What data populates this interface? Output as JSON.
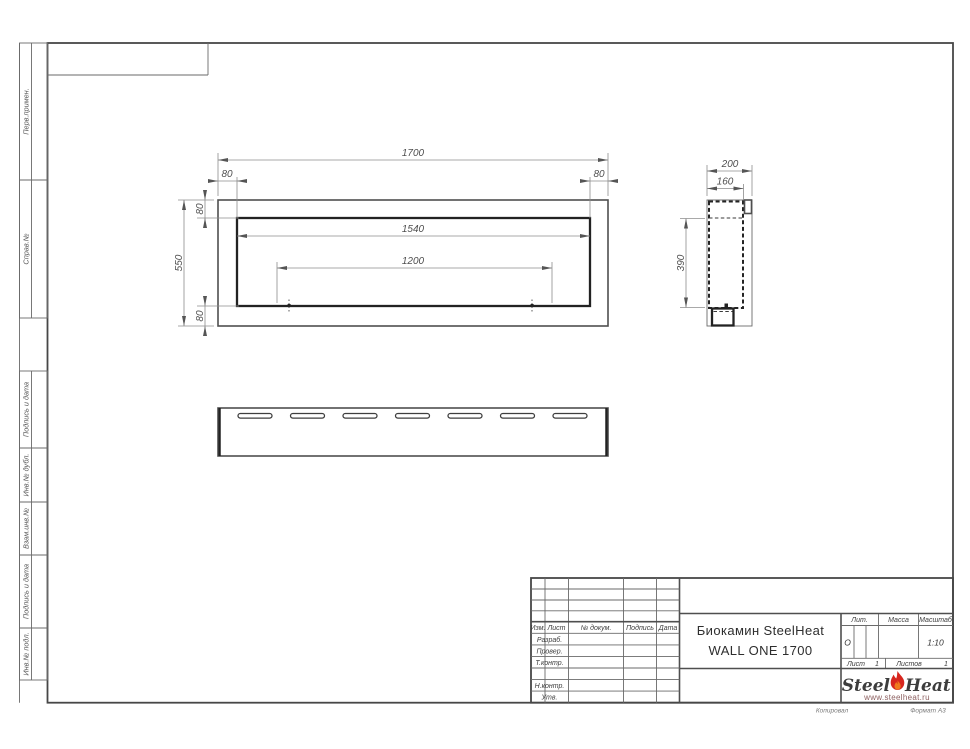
{
  "sheet": {
    "margin_labels_top": [
      "Перв.примен.",
      "Справ.№"
    ],
    "margin_labels_bottom": [
      "Подпись и дата",
      "Инв.№ дубл.",
      "Взам.инв.№",
      "Подпись и дата",
      "Инв.№ подл."
    ],
    "footer": {
      "copy_note": "Копировал",
      "format_note": "Формат А3"
    }
  },
  "drawing": {
    "front_view": {
      "width_total": "1700",
      "offset_left": "80",
      "offset_right": "80",
      "offset_top": "80",
      "height_total": "550",
      "width_inner": "1540",
      "mount_spacing": "1200",
      "offset_bottom": "80"
    },
    "side_view": {
      "depth_total": "200",
      "depth_inner": "160",
      "height_inner": "390"
    }
  },
  "title_block": {
    "columns": {
      "izm": "Изм.",
      "list": "Лист",
      "doc_no": "№ докум.",
      "podpis": "Подпись",
      "data": "Дата"
    },
    "rows": {
      "razrab": "Разраб.",
      "prover": "Провер.",
      "t_kontr": "Т.контр.",
      "n_kontr": "Н.контр.",
      "utv": "Утв."
    },
    "doc_title_line1": "Биокамин SteelHeat",
    "doc_title_line2": "WALL ONE 1700",
    "lit": {
      "label": "Лит.",
      "value": "О"
    },
    "massa": {
      "label": "Масса"
    },
    "masshtab": {
      "label": "Масштаб",
      "value": "1:10"
    },
    "list": {
      "label": "Лист",
      "value": "1"
    },
    "listov": {
      "label": "Листов",
      "value": "1"
    },
    "logo": {
      "part1": "Steel",
      "part2": "Heat",
      "site": "www.steelheat.ru"
    }
  }
}
